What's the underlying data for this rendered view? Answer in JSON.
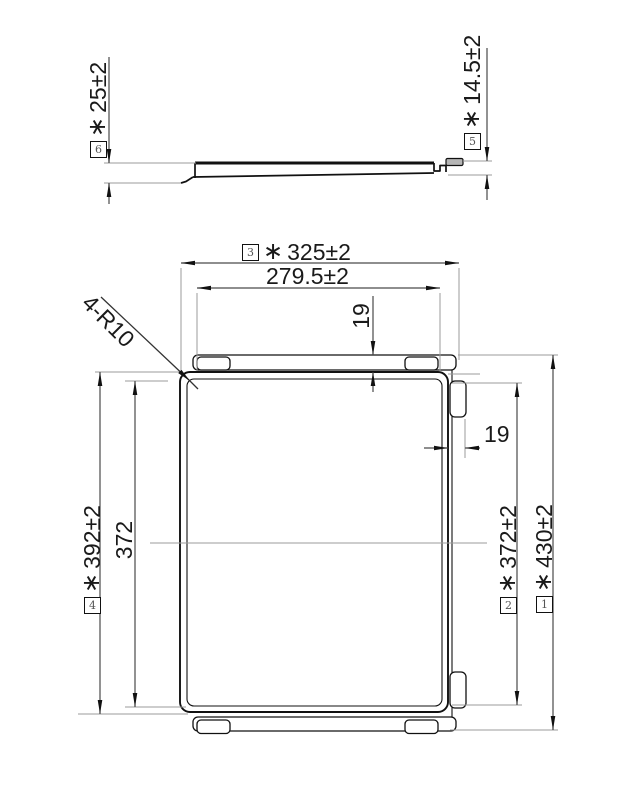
{
  "drawing_labels": {
    "side_view": {
      "height_left": {
        "ref": "6",
        "star": "∗",
        "value": "25±2"
      },
      "height_right": {
        "ref": "5",
        "star": "∗",
        "value": "14.5±2"
      }
    },
    "plan_view": {
      "width_overall": {
        "ref": "3",
        "star": "∗",
        "value": "325±2"
      },
      "width_inner": {
        "value": "279.5±2"
      },
      "offset_top": {
        "value": "19"
      },
      "offset_right": {
        "value": "19"
      },
      "corner_radius": {
        "value": "4-R10"
      },
      "height_body": {
        "ref": "4",
        "star": "∗",
        "value": "392±2"
      },
      "height_inner_left": {
        "value": "372"
      },
      "height_tabs_right": {
        "ref": "2",
        "star": "∗",
        "value": "372±2"
      },
      "height_overall": {
        "ref": "1",
        "star": "∗",
        "value": "430±2"
      }
    },
    "colors": {
      "line": "#111111",
      "extension_line": "#9b9b9b",
      "pad_fill": "#b5b5b5",
      "background": "#ffffff"
    }
  }
}
